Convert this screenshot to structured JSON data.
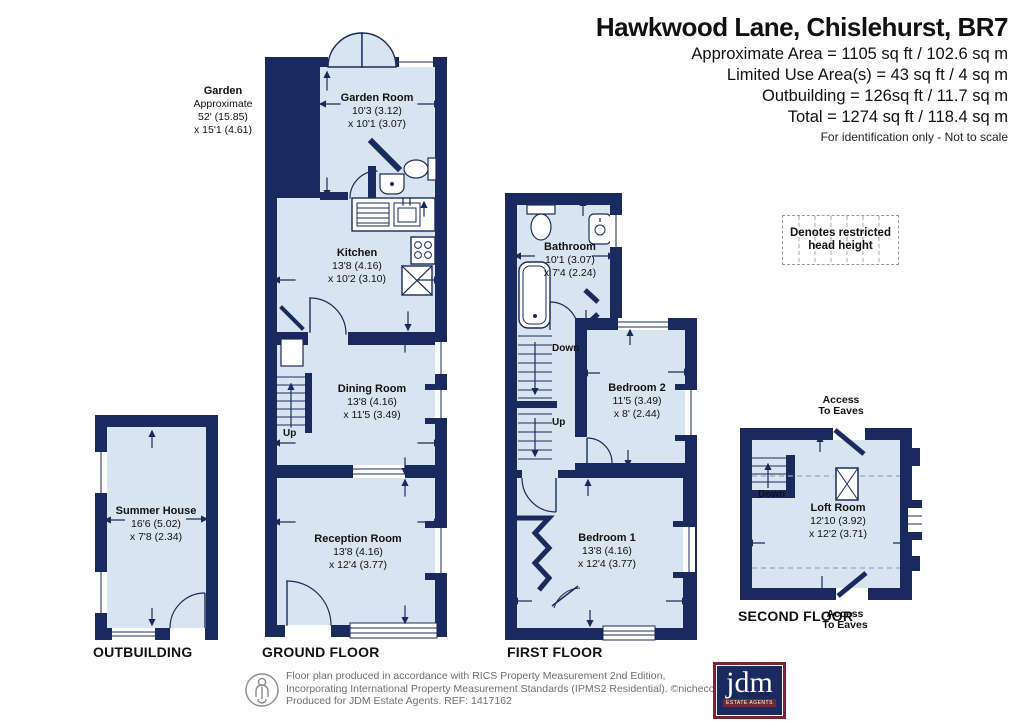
{
  "header": {
    "title": "Hawkwood Lane, Chislehurst, BR7",
    "area_lines": [
      "Approximate Area = 1105 sq ft / 102.6 sq m",
      "Limited Use Area(s) = 43 sq ft / 4 sq m",
      "Outbuilding = 126sq ft / 11.7 sq m",
      "Total = 1274 sq ft / 118.4 sq m"
    ],
    "disclaimer": "For identification only - Not to scale"
  },
  "legend": {
    "line1": "Denotes restricted",
    "line2": "head height"
  },
  "garden_note": {
    "title": "Garden",
    "line1": "Approximate",
    "line2": "52' (15.85)",
    "line3": "x 15'1 (4.61)"
  },
  "rooms": {
    "garden_room": {
      "name": "Garden Room",
      "dim1": "10'3 (3.12)",
      "dim2": "x 10'1 (3.07)"
    },
    "kitchen": {
      "name": "Kitchen",
      "dim1": "13'8 (4.16)",
      "dim2": "x 10'2 (3.10)"
    },
    "dining_room": {
      "name": "Dining Room",
      "dim1": "13'8 (4.16)",
      "dim2": "x 11'5 (3.49)"
    },
    "reception_room": {
      "name": "Reception Room",
      "dim1": "13'8 (4.16)",
      "dim2": "x 12'4 (3.77)"
    },
    "bathroom": {
      "name": "Bathroom",
      "dim1": "10'1 (3.07)",
      "dim2": "x 7'4 (2.24)"
    },
    "bedroom2": {
      "name": "Bedroom 2",
      "dim1": "11'5 (3.49)",
      "dim2": "x 8' (2.44)"
    },
    "bedroom1": {
      "name": "Bedroom 1",
      "dim1": "13'8 (4.16)",
      "dim2": "x 12'4 (3.77)"
    },
    "summer_house": {
      "name": "Summer House",
      "dim1": "16'6 (5.02)",
      "dim2": "x 7'8 (2.34)"
    },
    "loft_room": {
      "name": "Loft Room",
      "dim1": "12'10 (3.92)",
      "dim2": "x 12'2 (3.71)"
    }
  },
  "labels": {
    "outbuilding": "OUTBUILDING",
    "ground": "GROUND FLOOR",
    "first": "FIRST FLOOR",
    "second": "SECOND FLOOR"
  },
  "stairs": {
    "up": "Up",
    "down": "Down"
  },
  "eaves": {
    "line1": "Access",
    "line2": "To Eaves"
  },
  "footer": {
    "line1": "Floor plan produced in accordance with RICS Property Measurement 2nd Edition,",
    "line2": "Incorporating International Property Measurement Standards (IPMS2 Residential).   ©nichecom 2026.",
    "line3": "Produced for JDM Estate Agents.   REF: 1417162",
    "logo_text": "jdm",
    "logo_sub": "ESTATE AGENTS"
  },
  "colors": {
    "wall": "#1b2a5e",
    "room": "#d8e4f0",
    "logo_maroon": "#7b2433",
    "footer_gray": "#6e6e6e"
  }
}
